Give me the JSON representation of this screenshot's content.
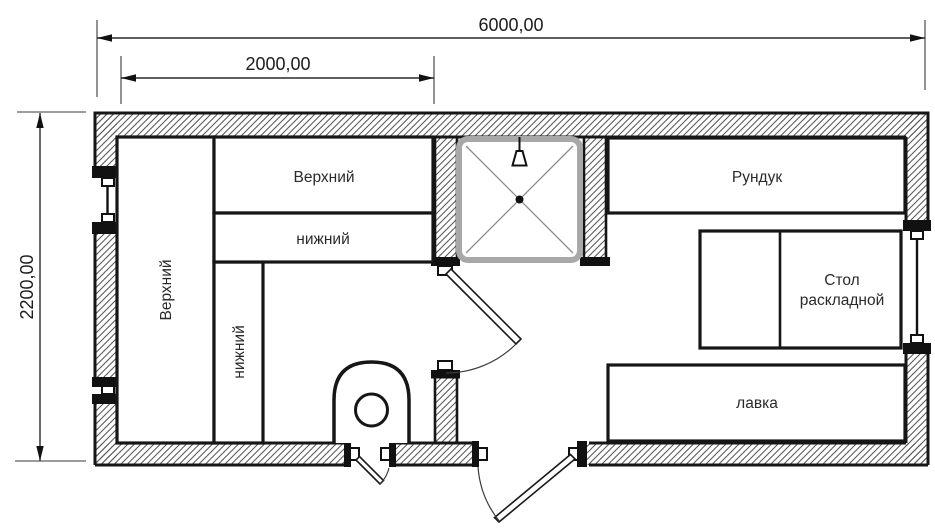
{
  "plan": {
    "dimensions": {
      "overall_width": "6000,00",
      "berth_zone_width": "2000,00",
      "overall_depth": "2200,00"
    },
    "labels": {
      "top_shelf_upper": "Верхний",
      "top_shelf_lower": "нижний",
      "side_bunk_upper": "Верхний",
      "side_bunk_lower": "нижний",
      "locker": "Рундук",
      "folding_table_line1": "Стол",
      "folding_table_line2": "раскладной",
      "bench": "лавка"
    },
    "colors": {
      "ink": "#161616",
      "hatch_line": "#555555",
      "shower_tray_border": "#a8a8a8",
      "paper": "#ffffff"
    }
  }
}
